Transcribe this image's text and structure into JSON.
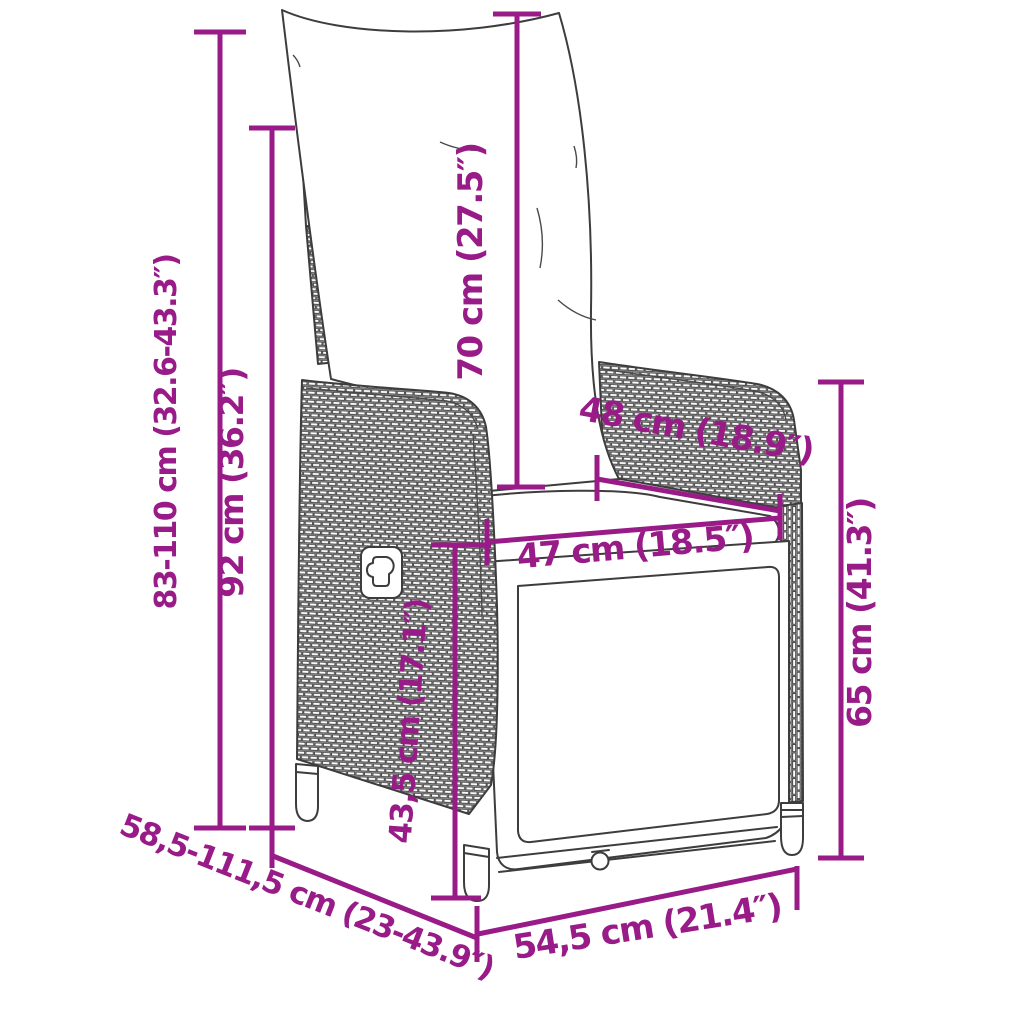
{
  "figure": {
    "kind": "product-dimension-diagram",
    "subject": "reclining wicker garden chair with back cushion and footrest"
  },
  "colors": {
    "dimension_accent": "#981B88",
    "line_art": "#3D3D3D",
    "background": "#FFFFFF"
  },
  "dims": {
    "total_height": "83-110 cm (32.6-43.3″)",
    "back_height": "92 cm (36.2″)",
    "back_cushion_height": "70 cm (27.5″)",
    "top_width": "48 cm (18.9″)",
    "seat_width": "47 cm (18.5″)",
    "armrest_height": "65 cm (41.3″)",
    "seat_height": "43,5 cm (17.1″)",
    "depth_range": "58,5-111,5 cm (23-43.9″)",
    "base_width": "54,5 cm (21.4″)"
  }
}
